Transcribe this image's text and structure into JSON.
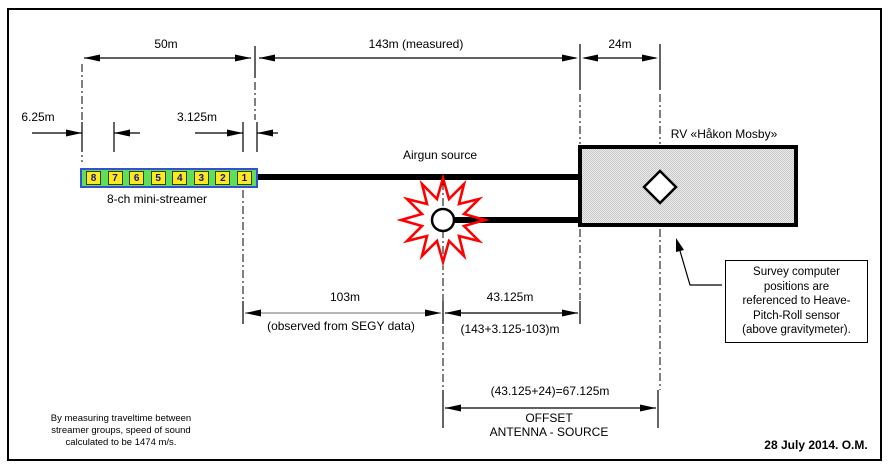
{
  "diagram": {
    "dimensions": {
      "streamer_span": "50m",
      "measured_cable": "143m (measured)",
      "stern_to_antenna": "24m",
      "group_spacing": "6.25m",
      "half_group": "3.125m",
      "segy_offset": "103m",
      "segy_offset_note": "(observed from SEGY data)",
      "source_to_stern": "43.125m",
      "source_to_stern_calc": "(143+3.125-103)m",
      "antenna_source_sum": "(43.125+24)=67.125m",
      "offset_word": "OFFSET",
      "offset_subject": "ANTENNA - SOURCE"
    },
    "labels": {
      "airgun": "Airgun source",
      "vessel": "RV «Håkon Mosby»",
      "streamer": "8-ch mini-streamer"
    },
    "streamer_channels": [
      "8",
      "7",
      "6",
      "5",
      "4",
      "3",
      "2",
      "1"
    ],
    "callout_lines": [
      "Survey computer",
      "positions are",
      "referenced to Heave-",
      "Pitch-Roll sensor",
      "(above gravitymeter)."
    ],
    "note_lines": [
      "By measuring traveltime between",
      "streamer groups, speed of sound",
      "calculated to be 1474 m/s."
    ],
    "date": "28 July 2014. O.M.",
    "colors": {
      "line": "#000000",
      "segy_dim_line": "#8a8a8a",
      "starburst": "#ff0000",
      "streamer_fill": "#5ce05c",
      "streamer_border": "#3351d1",
      "channel_fill": "#ffe81e",
      "channel_number": "#14148c",
      "ship_fill": "#d9d9d9"
    }
  }
}
